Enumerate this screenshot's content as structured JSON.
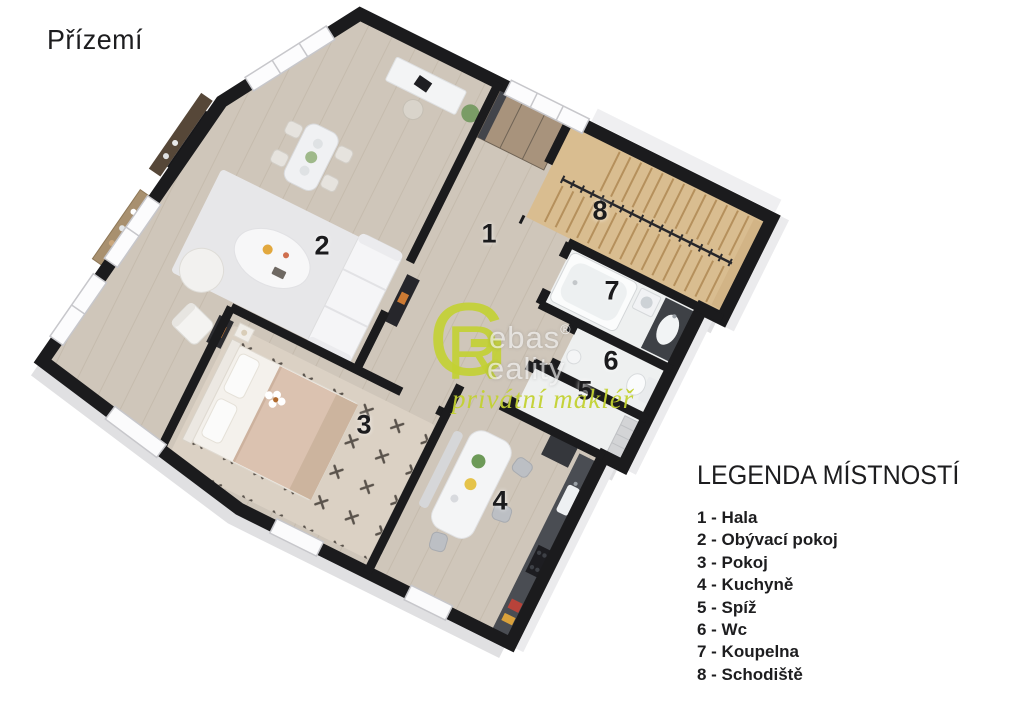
{
  "title": "Přízemí",
  "watermark": {
    "logo_letter_g": "G",
    "logo_letter_r": "R",
    "brand_top_suffix": "ebas",
    "brand_bottom_suffix": "eality",
    "registered_mark": "®",
    "tagline": "privátní makléř",
    "accent_color": "#c3d232"
  },
  "legend": {
    "heading": "LEGENDA MÍSTNOSTÍ",
    "items": [
      {
        "number": "1",
        "name": "Hala",
        "label": "1 - Hala"
      },
      {
        "number": "2",
        "name": "Obývací pokoj",
        "label": "2 - Obývací pokoj"
      },
      {
        "number": "3",
        "name": "Pokoj",
        "label": "3 - Pokoj"
      },
      {
        "number": "4",
        "name": "Kuchyně",
        "label": "4 - Kuchyně"
      },
      {
        "number": "5",
        "name": "Spíž",
        "label": "5 - Spíž"
      },
      {
        "number": "6",
        "name": "Wc",
        "label": "6 - Wc"
      },
      {
        "number": "7",
        "name": "Koupelna",
        "label": "7 - Koupelna"
      },
      {
        "number": "8",
        "name": "Schodiště",
        "label": "8 - Schodiště"
      }
    ]
  },
  "plan_colors": {
    "walls": "#1b1b1d",
    "floor_wood": "#cfc6ba",
    "stairs_wood": "#d9bd90",
    "tile": "#eef0f0",
    "rug": "#e7e7e9"
  }
}
